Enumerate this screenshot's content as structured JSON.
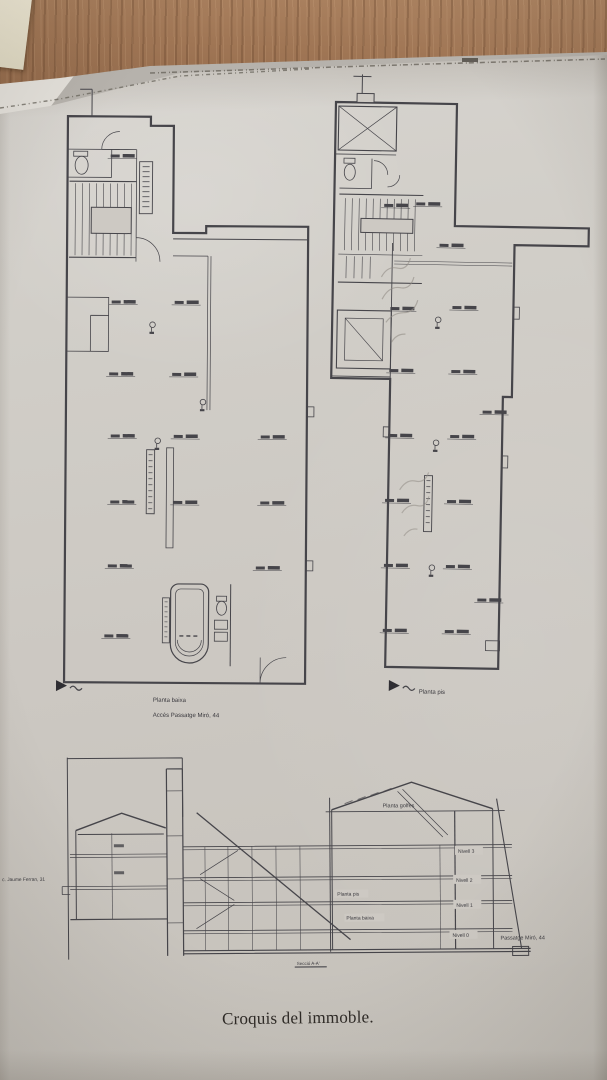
{
  "caption": "Croquis del immoble.",
  "ground_floor_plan": {
    "label": "Planta baixa",
    "sublabel": "Accés Passatge Miró, 44"
  },
  "first_floor_plan": {
    "label": "Planta pis"
  },
  "section": {
    "attic": "Planta golfes",
    "level3": "Nivell 3",
    "level2": "Nivell 2",
    "level1": "Nivell 1",
    "level0": "Nivell 0",
    "floor_pis": "Planta pis",
    "floor_baixa": "Planta baixa",
    "street_right": "Passatge Miró, 44",
    "street_left": "c. Jaume Ferran, 31",
    "ref": "Secció A-A'"
  },
  "colors": {
    "desk_wood": "#a07655",
    "paper": "#cdc9c3",
    "ink": "#46454a",
    "pencil": "#928d86",
    "sticky_note": "#eae5d0"
  }
}
